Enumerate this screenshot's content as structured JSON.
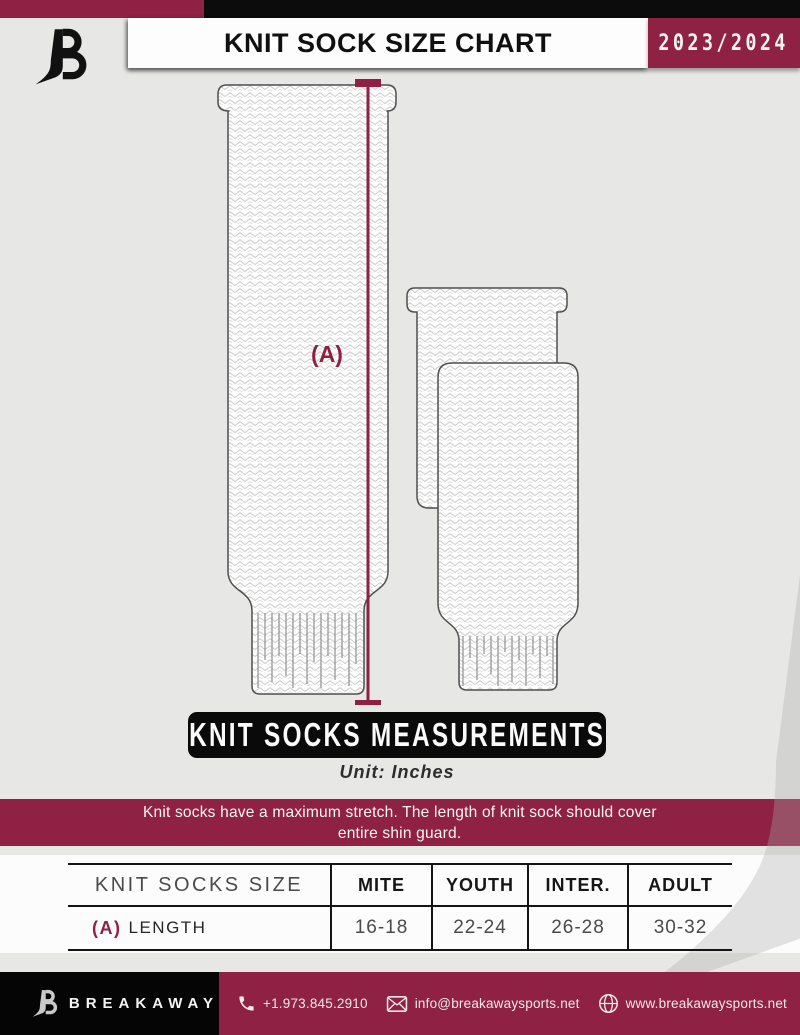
{
  "header": {
    "title": "KNIT SOCK SIZE CHART",
    "season": "2023/2024"
  },
  "diagram": {
    "measure_label": "(A)"
  },
  "banner": {
    "title": "KNIT SOCKS MEASUREMENTS",
    "unit": "Unit: Inches"
  },
  "notice": {
    "line1": "Knit socks have a maximum stretch. The length of knit sock should cover",
    "line2": "entire shin guard."
  },
  "table": {
    "row_header": "KNIT SOCKS SIZE",
    "columns": [
      "MITE",
      "YOUTH",
      "INTER.",
      "ADULT"
    ],
    "rows": [
      {
        "key": "(A)",
        "label": "LENGTH",
        "values": [
          "16-18",
          "22-24",
          "26-28",
          "30-32"
        ]
      }
    ]
  },
  "footer": {
    "brand": "BREAKAWAY",
    "phone": "+1.973.845.2910",
    "email": "info@breakawaysports.net",
    "website": "www.breakawaysports.net"
  },
  "colors": {
    "maroon": "#8e2144",
    "black": "#0c0c0c",
    "background_gray": "#e7e7e6",
    "knit_stroke": "#cacaca"
  }
}
